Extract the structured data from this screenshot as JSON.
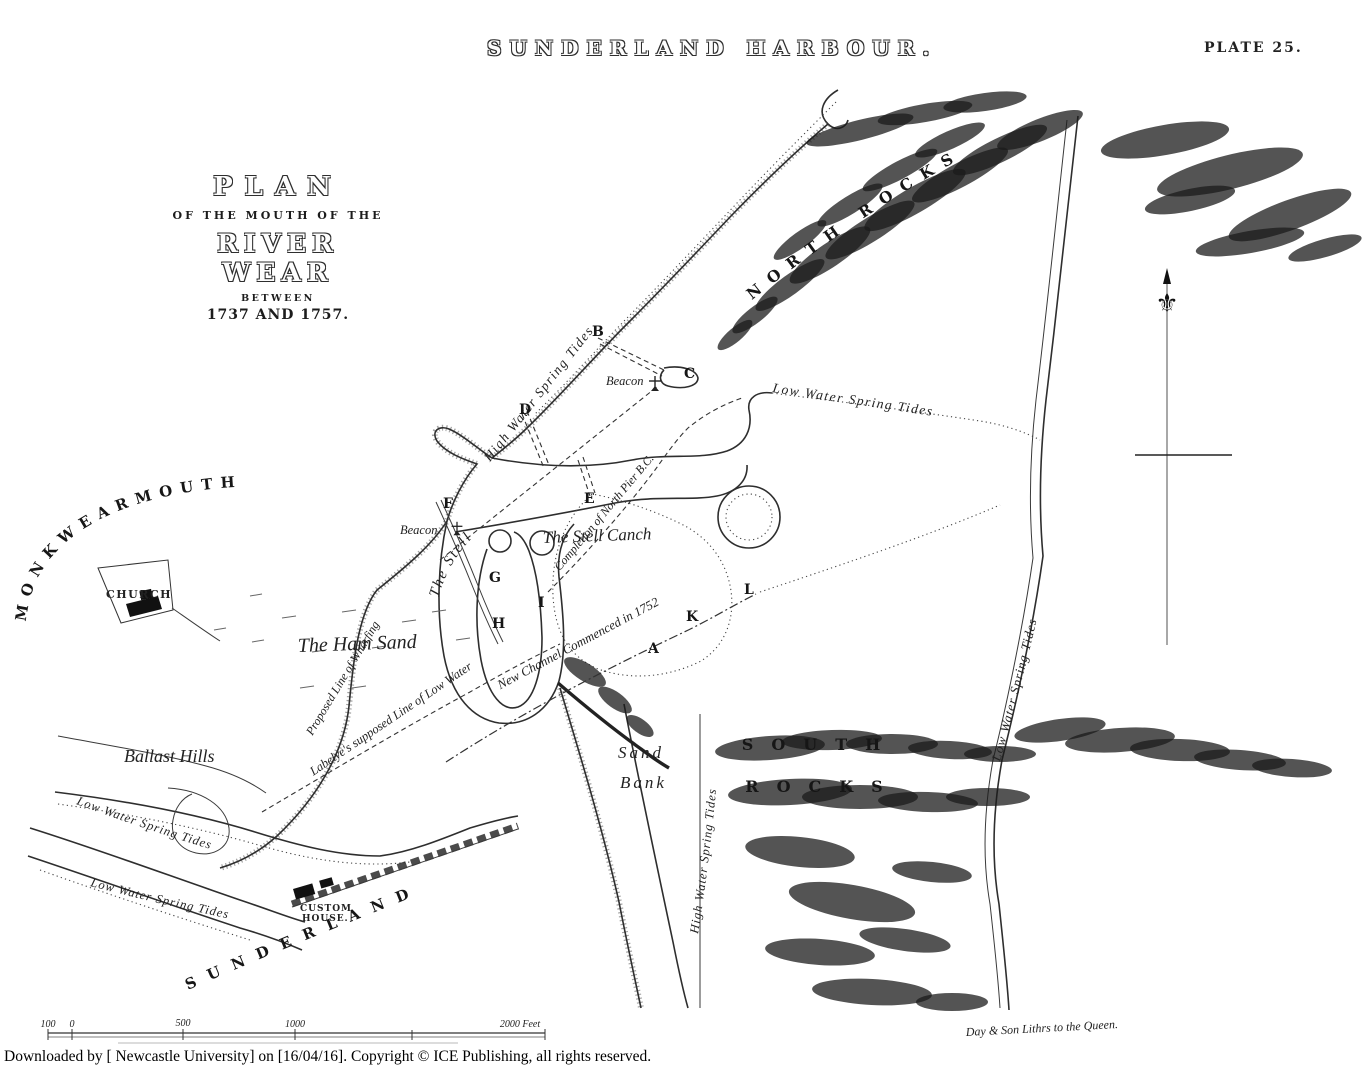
{
  "header": {
    "title": "SUNDERLAND HARBOUR.",
    "plate": "PLATE 25."
  },
  "title_block": {
    "plan": "PLAN",
    "of_the": "OF THE MOUTH OF THE",
    "river_wear": "RIVER WEAR",
    "between": "BETWEEN",
    "dates": "1737 AND 1757."
  },
  "map_labels": {
    "monkwearmouth": "MONKWEARMOUTH",
    "church": "CHURCH",
    "ham_sand": "The Ham Sand",
    "ballast_hills": "Ballast Hills",
    "the_stell": "The Stell",
    "stell_canch": "The Stell Canch",
    "sand_bank_1": "Sand",
    "sand_bank_2": "Bank",
    "north_rocks": "NORTH ROCKS",
    "south_rocks_1": "SOUTH",
    "south_rocks_2": "ROCKS",
    "sunderland": "SUNDERLAND",
    "custom_house_1": "CUSTOM",
    "custom_house_2": "HOUSE.",
    "beacon_left": "Beacon",
    "beacon_right": "Beacon",
    "low_water_spring_tides_top": "Low Water Spring Tides",
    "low_water_spring_tides_right": "Low Water Spring Tides",
    "low_water_spring_tides_west_1": "Low Water Spring Tides",
    "low_water_spring_tides_west_2": "Low Water Spring Tides",
    "high_water_spring_tides_north": "High Water Spring Tides",
    "high_water_spring_tides_sandbank": "High Water Spring Tides",
    "proposed_line": "Proposed Line of Wharfing",
    "labelyes_line": "Labelye's supposed Line of Low Water",
    "completion_line": "Completion of North Pier B.C.",
    "new_channel_line": "New Channel Commenced in 1752"
  },
  "reference_letters": {
    "a": "A",
    "b": "B",
    "c": "C",
    "d": "D",
    "e": "E",
    "f": "F",
    "g": "G",
    "h": "H",
    "i": "I",
    "k": "K",
    "l": "L"
  },
  "scale_bar": {
    "labels": [
      "100",
      "0",
      "500",
      "1000",
      "2000 Feet"
    ]
  },
  "credits": {
    "lithographer": "Day & Son Lithrs to the Queen."
  },
  "footer": {
    "text": "Downloaded by [ Newcastle University] on [16/04/16]. Copyright © ICE Publishing, all rights reserved."
  }
}
